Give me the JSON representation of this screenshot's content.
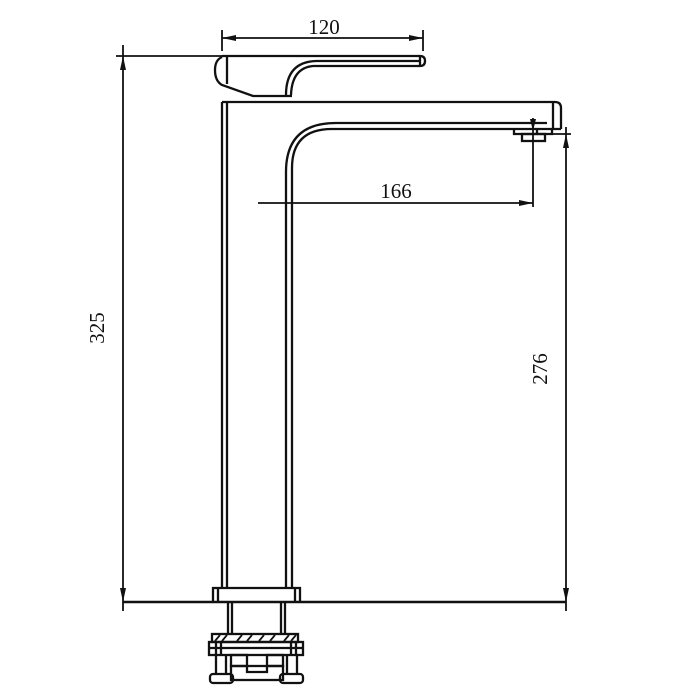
{
  "colors": {
    "line": "#111111",
    "background": "#ffffff"
  },
  "dimensions": {
    "handle_length": {
      "value": "120"
    },
    "spout_reach": {
      "value": "166"
    },
    "overall_height": {
      "value": "325"
    },
    "outlet_height": {
      "value": "276"
    }
  }
}
